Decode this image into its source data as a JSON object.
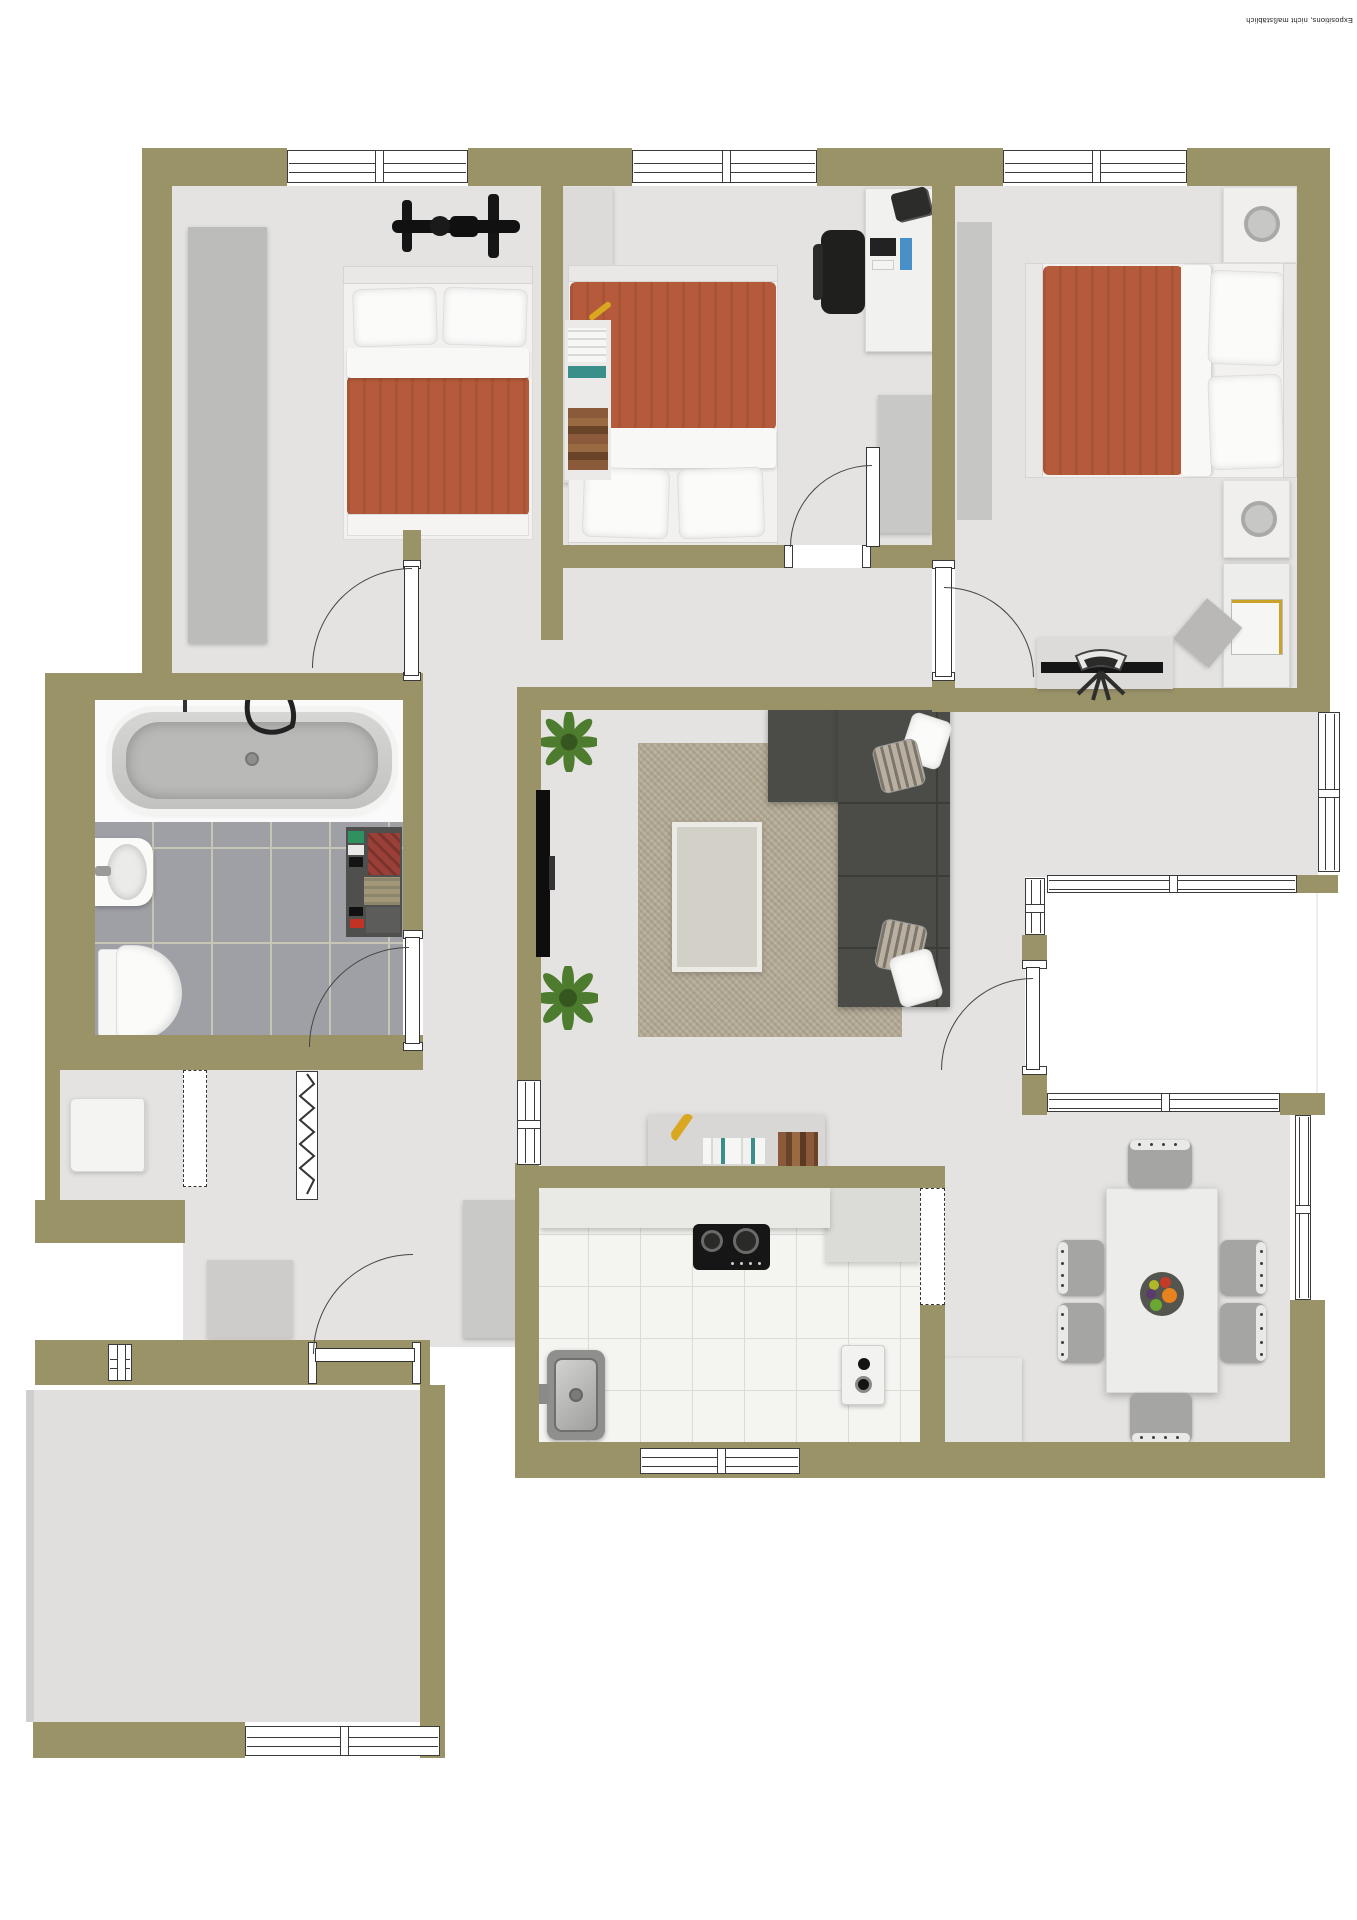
{
  "watermark": {
    "text": "Expositions, nicht maßstäblich"
  },
  "colors": {
    "wall": "#9b9368",
    "floor": "#e4e3e1",
    "floor2": "#e0dfdd",
    "accent": "#b55a3a",
    "sofa": "#4b4b47",
    "rug": "#b4ab96",
    "bathtile": "#9fa0a6",
    "kitchentile": "#f4f4f1",
    "furngray": "#c3c3c1",
    "plant": "#4e7c2e",
    "dark": "#1d1d1b"
  },
  "plan": {
    "type": "apartment-floor-plan-top-view",
    "rooms": [
      {
        "id": "bedroom-1",
        "furniture": [
          "wardrobe",
          "double-bed-terracotta",
          "bicycle"
        ]
      },
      {
        "id": "bedroom-2",
        "furniture": [
          "wardrobe-with-books",
          "double-bed-terracotta",
          "desk",
          "office-chair",
          "monitor",
          "printer",
          "cabinet"
        ]
      },
      {
        "id": "bedroom-3",
        "furniture": [
          "nightstand-with-lamp",
          "double-bed-terracotta",
          "nightstand-with-lamp",
          "desk-with-tv",
          "office-chair",
          "corner-shelf",
          "floor-runner"
        ]
      },
      {
        "id": "bathroom",
        "furniture": [
          "bathtub",
          "washbasin",
          "toilet",
          "shelf-with-clothes"
        ]
      },
      {
        "id": "hallway",
        "furniture": [
          "hall-cabinet",
          "doormat",
          "coat-closet-folding-door"
        ]
      },
      {
        "id": "storage-room",
        "furniture": [
          "washing-machine"
        ]
      },
      {
        "id": "living-room",
        "furniture": [
          "wall-tv",
          "plant",
          "plant",
          "rug",
          "coffee-table",
          "corner-sofa-with-pillows",
          "wall-shelf-with-books"
        ]
      },
      {
        "id": "kitchen",
        "furniture": [
          "counter",
          "gas-hob",
          "sink",
          "small-appliance"
        ]
      },
      {
        "id": "dining-area",
        "furniture": [
          "dining-table",
          "chairs-x6",
          "fruit-bowl",
          "sideboard"
        ]
      },
      {
        "id": "balcony",
        "furniture": []
      },
      {
        "id": "bottom-left-room",
        "furniture": []
      }
    ]
  }
}
